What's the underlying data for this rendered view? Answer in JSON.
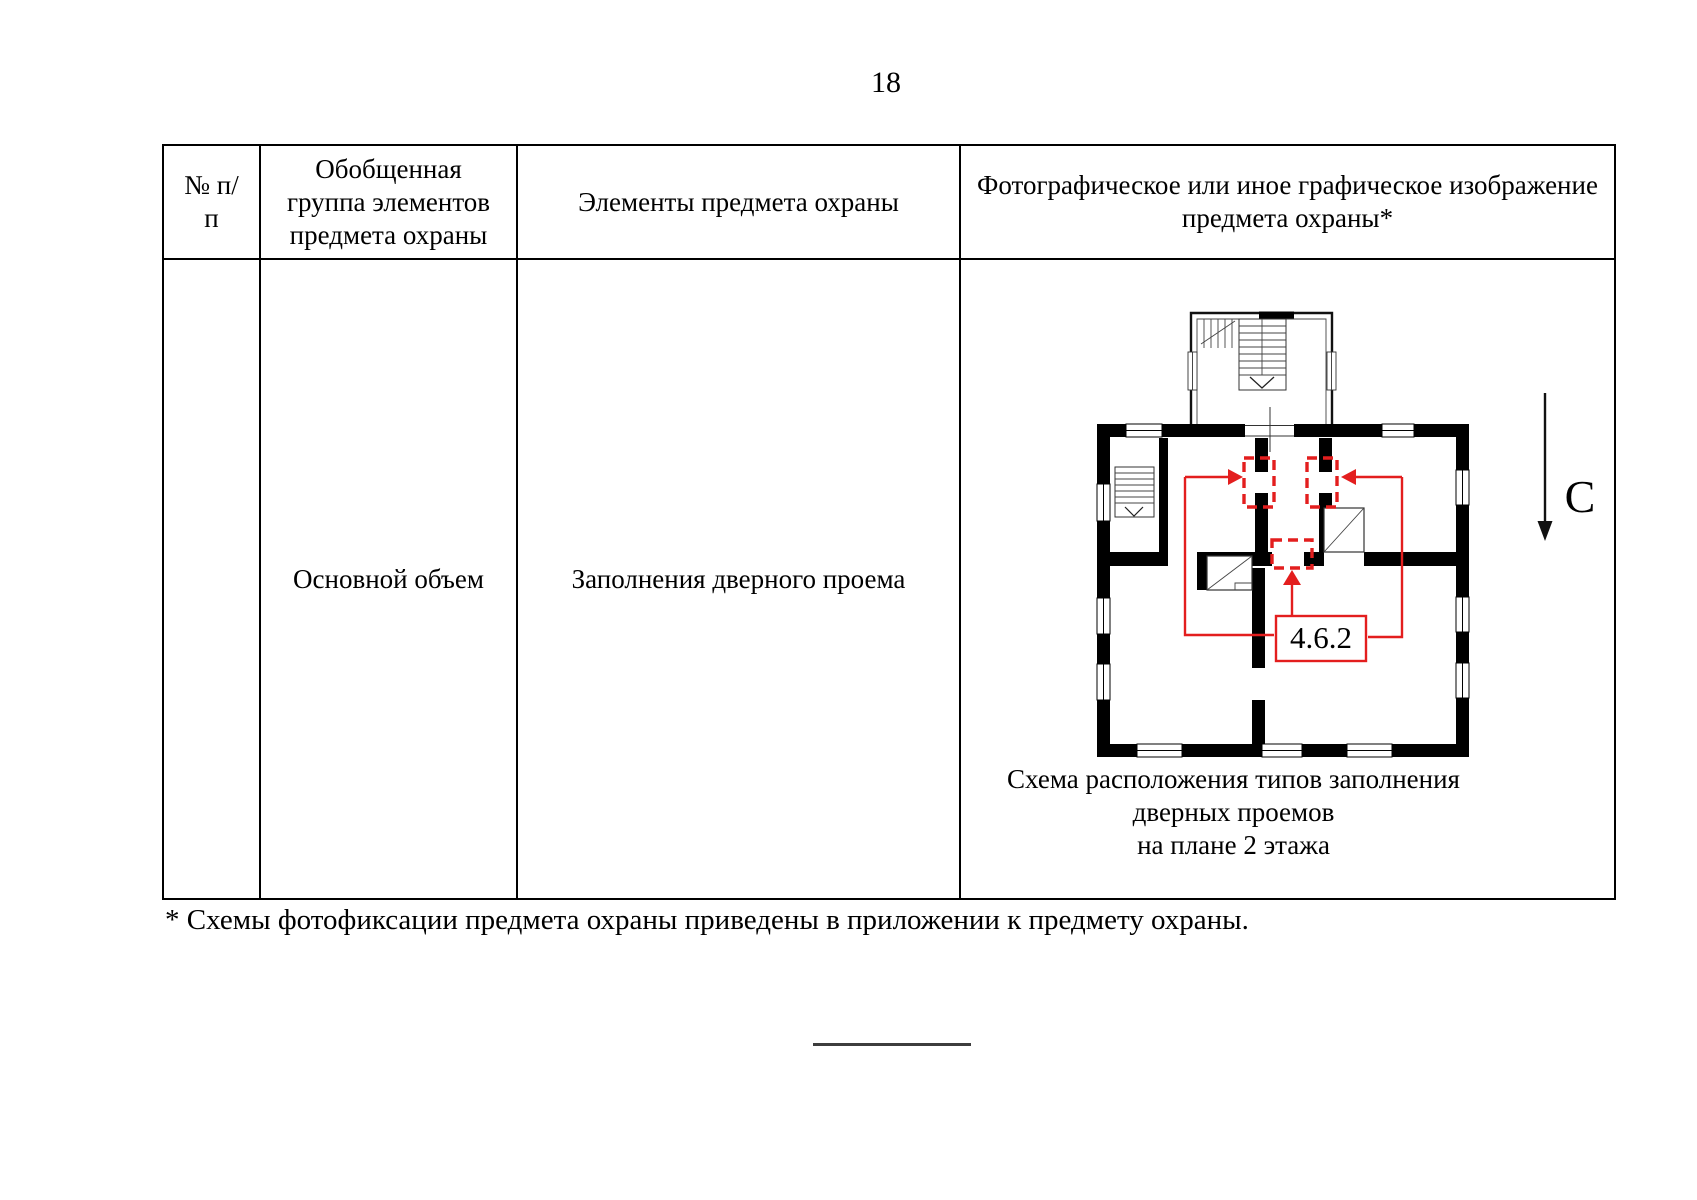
{
  "page": {
    "number": "18"
  },
  "table": {
    "headers": [
      "№ п/п",
      "Обобщенная группа элементов предмета охраны",
      "Элементы предмета охраны",
      "Фотографическое или иное графическое изображение предмета охраны*"
    ],
    "row": {
      "num": "",
      "group": "Основной объем",
      "element": "Заполнения дверного проема",
      "caption1": "Схема расположения типов заполнения дверных проемов",
      "caption2": "на плане 2 этажа"
    }
  },
  "plan": {
    "label": "4.6.2",
    "north_label": "С",
    "red_color": "#e31e1e"
  },
  "footnote": "* Схемы фотофиксации предмета охраны приведены в приложении к предмету охраны."
}
